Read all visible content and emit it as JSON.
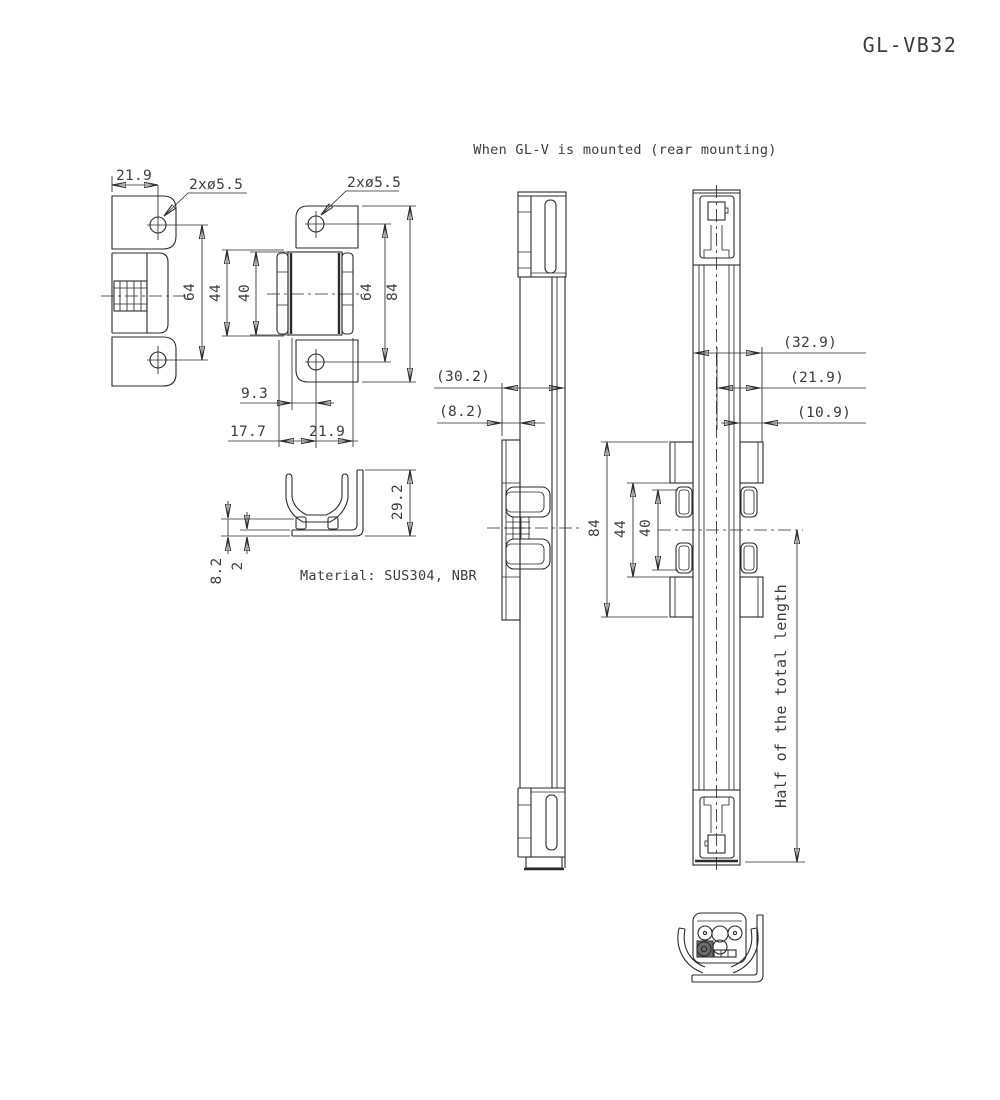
{
  "title": "GL-VB32",
  "caption": "When GL-V is mounted (rear mounting)",
  "material_note": "Material: SUS304, NBR",
  "bracket_front": {
    "width": "21.9",
    "holes": "2xø5.5",
    "hole_pitch": "64"
  },
  "bracket_mounted": {
    "holes": "2xø5.5",
    "clip_outer": "44",
    "clip_inner": "40",
    "hole_pitch": "64",
    "overall_height": "84",
    "offset_center": "9.3",
    "offset_left": "17.7",
    "offset_right": "21.9"
  },
  "section": {
    "height": "29.2",
    "lip_height": "8.2",
    "thickness": "2"
  },
  "side_mounted": {
    "depth_total": "(30.2)",
    "bracket_offset": "(8.2)"
  },
  "rear_mounted": {
    "depth_total": "(32.9)",
    "depth_mid": "(21.9)",
    "depth_inner": "(10.9)",
    "overall_height": "84",
    "clip_outer": "44",
    "clip_inner": "40",
    "half_note": "Half of the total length"
  }
}
